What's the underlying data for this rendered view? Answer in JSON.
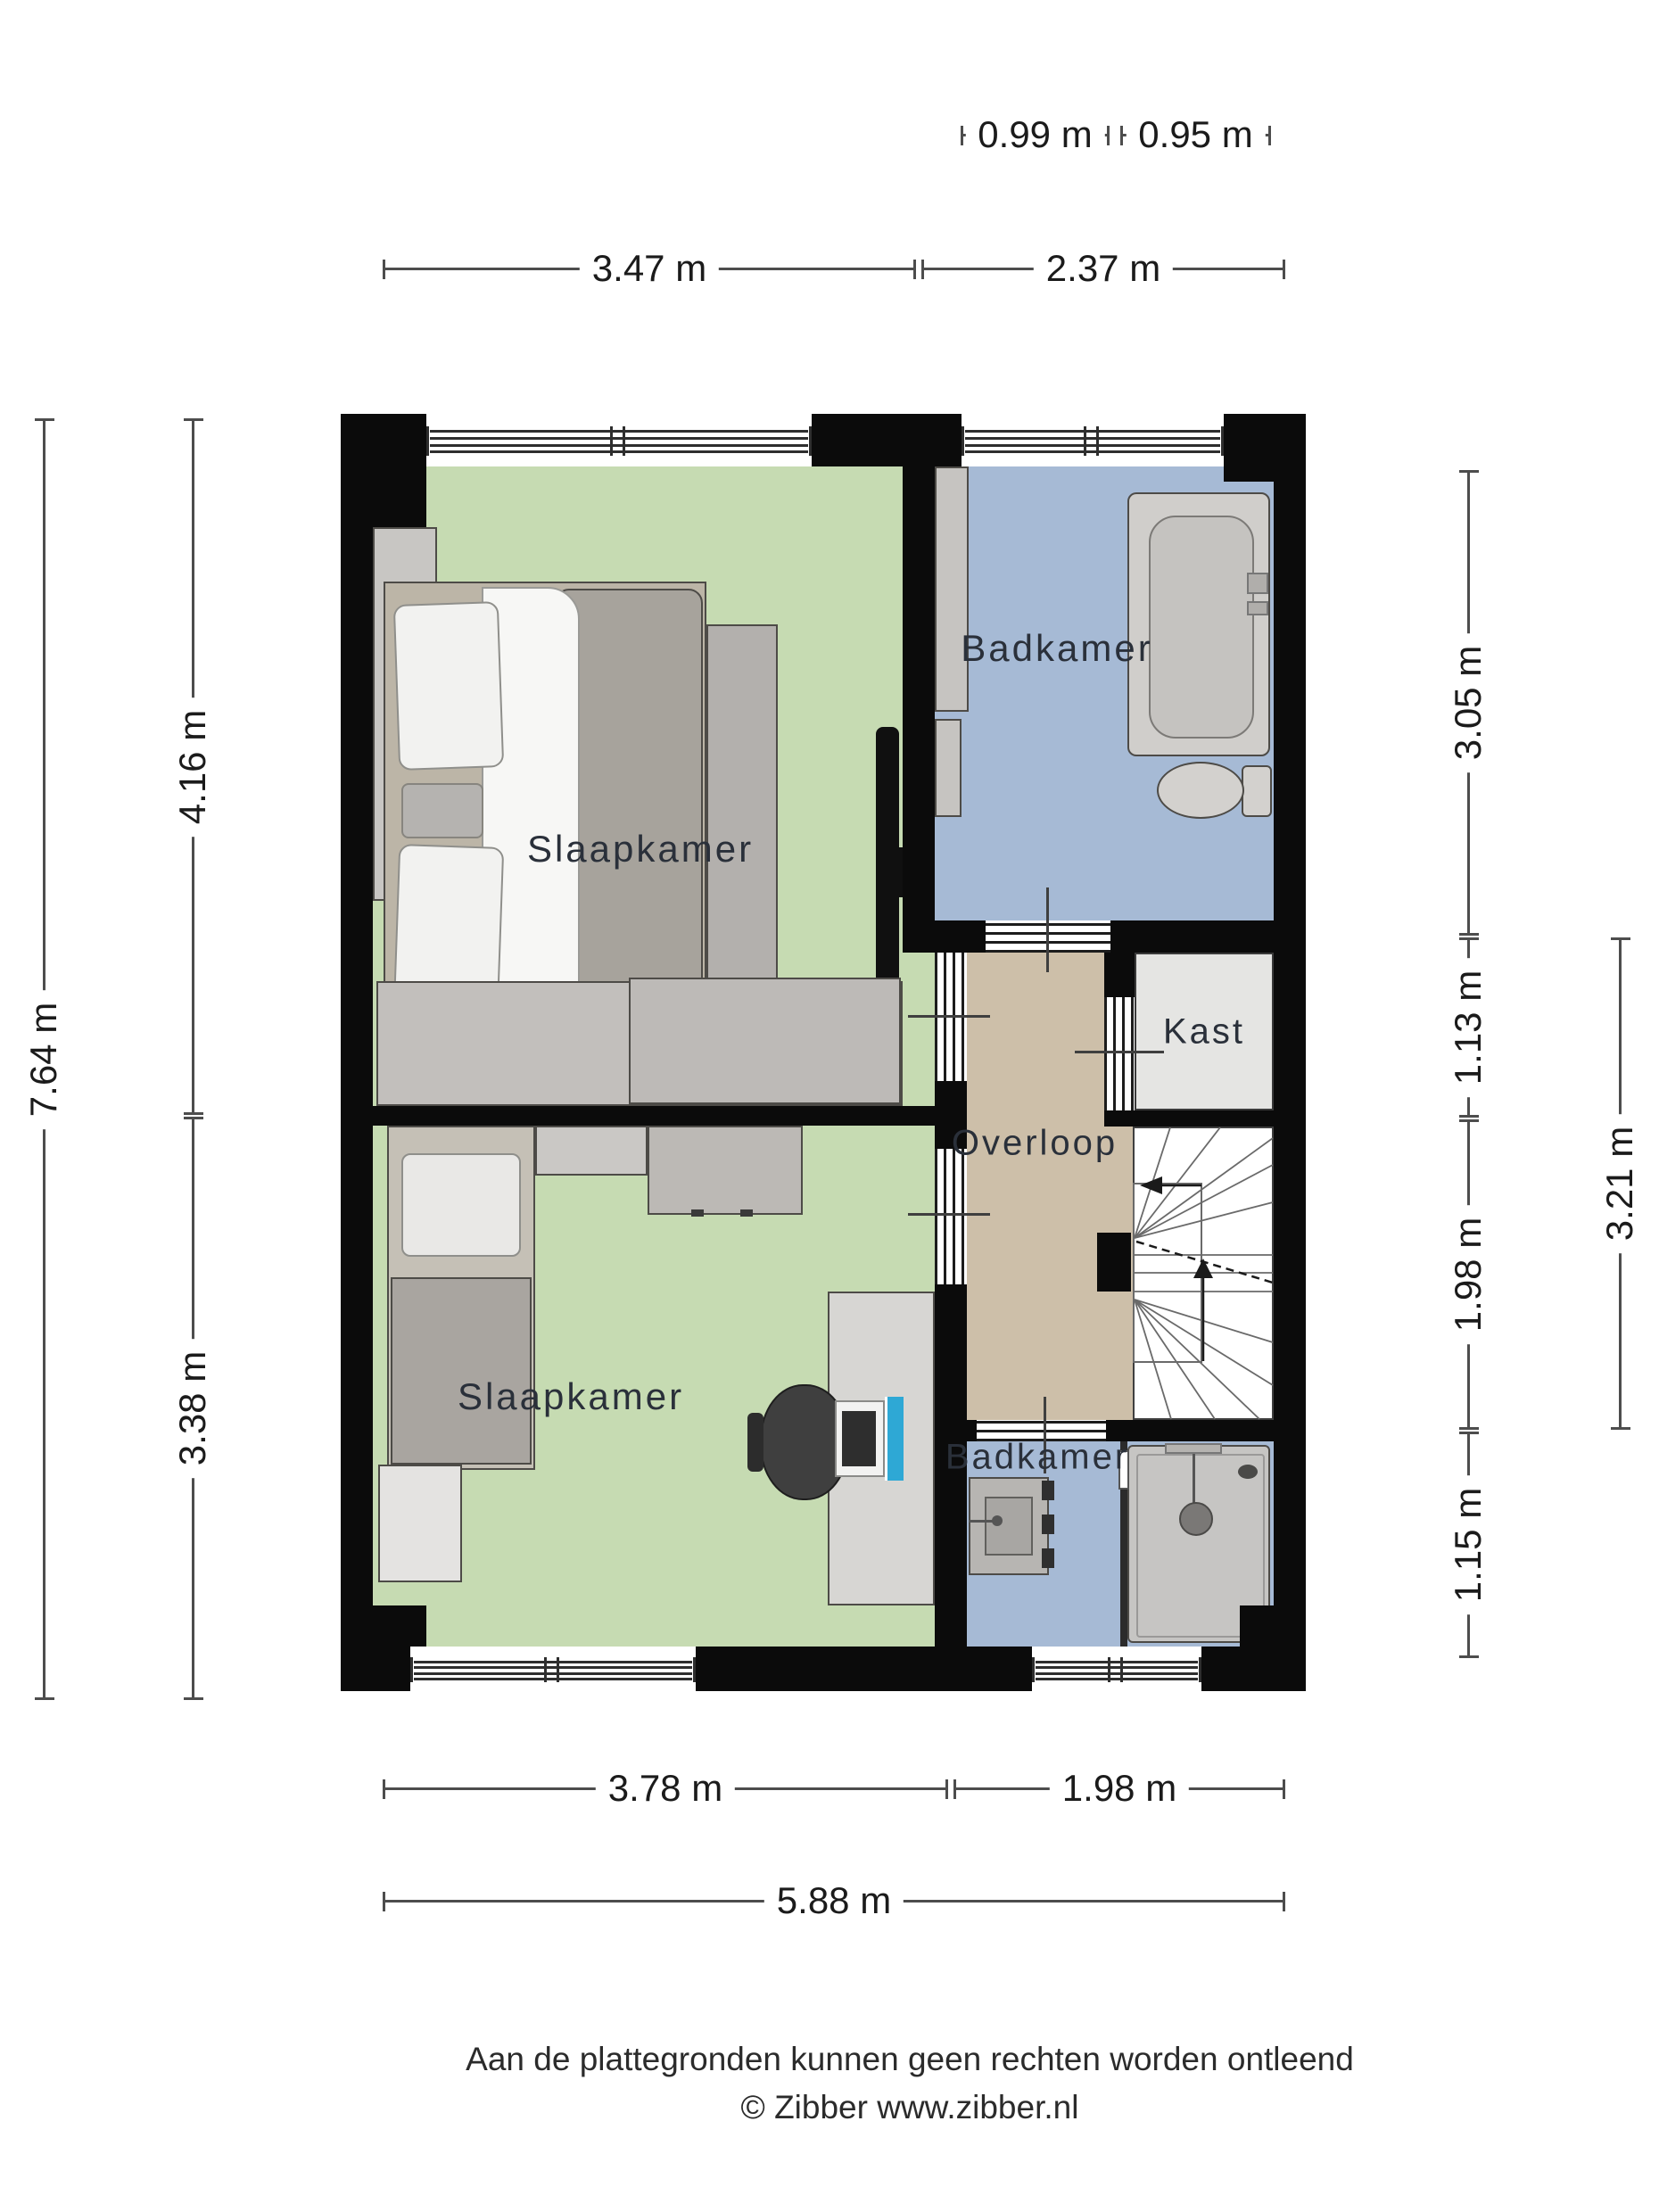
{
  "rooms": {
    "bedroom_top": {
      "label": "Slaapkamer"
    },
    "bathroom_top": {
      "label": "Badkamer"
    },
    "closet": {
      "label": "Kast"
    },
    "landing": {
      "label": "Overloop"
    },
    "bedroom_bottom": {
      "label": "Slaapkamer"
    },
    "bathroom_bottom": {
      "label": "Badkamer"
    }
  },
  "dims": {
    "top_small": [
      "0.99 m",
      "0.95 m"
    ],
    "top": [
      "3.47 m",
      "2.37 m"
    ],
    "left_outer": "7.64 m",
    "left_inner": [
      "4.16 m",
      "3.38 m"
    ],
    "right_inner": [
      "3.05 m",
      "1.13 m",
      "1.98 m",
      "1.15 m"
    ],
    "right_outer": "3.21 m",
    "bottom": [
      "3.78 m",
      "1.98 m"
    ],
    "bottom_total": "5.88 m"
  },
  "footer": {
    "line1": "Aan de plattegronden kunnen geen rechten worden ontleend",
    "line2": "© Zibber www.zibber.nl"
  },
  "colors": {
    "wall": "#0b0b0b",
    "bedroom": "#c6dbb2",
    "bathroom": "#a6bad5",
    "landing": "#cdbfa9",
    "closet": "#e5e5e3",
    "accent-screen": "#2ea8d5"
  }
}
